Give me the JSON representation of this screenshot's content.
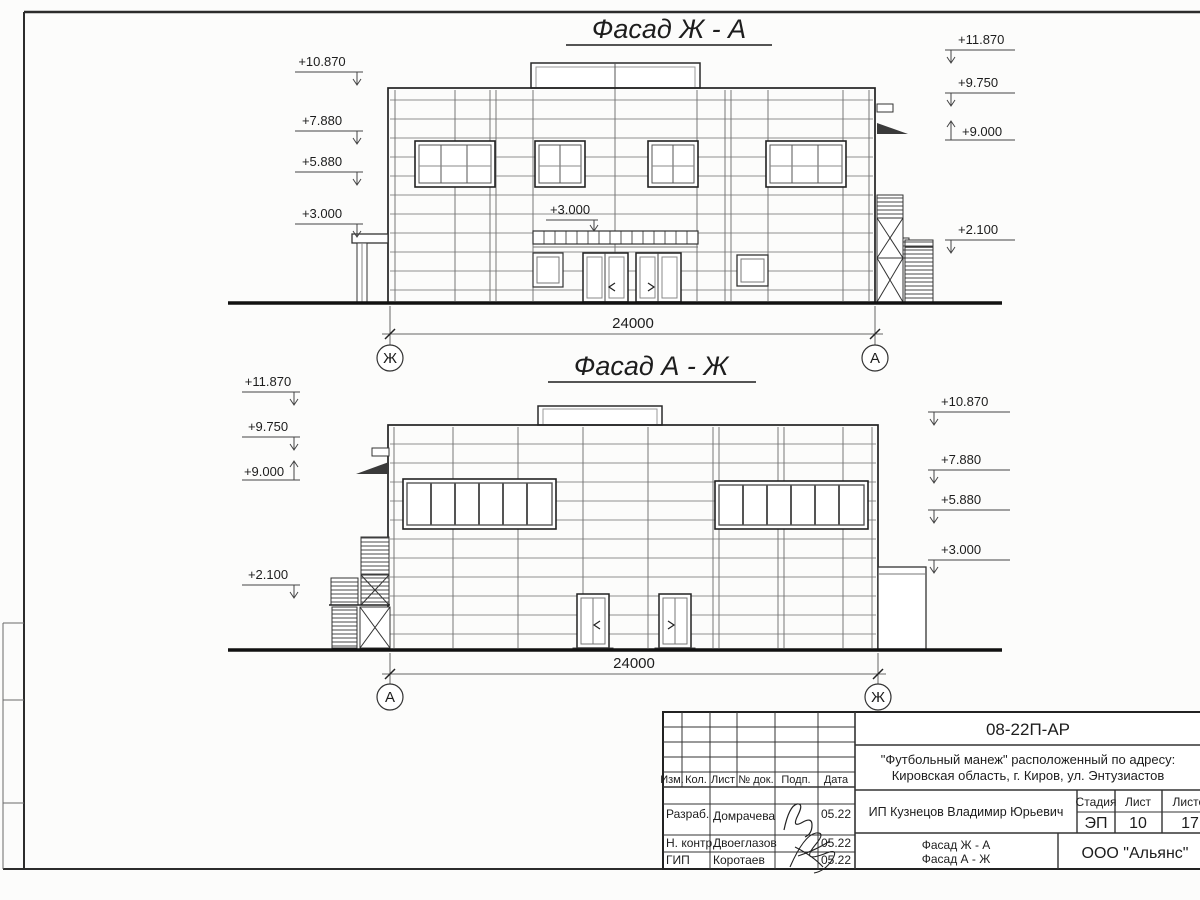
{
  "drawing": {
    "facade1": {
      "title": "Фасад Ж - А",
      "left_marks": [
        "+10.870",
        "+7.880",
        "+5.880",
        "+3.000"
      ],
      "right_marks": [
        "+11.870",
        "+9.750",
        "+9.000",
        "+2.100"
      ],
      "entrance_mark": "+3.000",
      "dimension": "24000",
      "axis_left": "Ж",
      "axis_right": "А"
    },
    "facade2": {
      "title": "Фасад А - Ж",
      "left_marks": [
        "+11.870",
        "+9.750",
        "+9.000",
        "+2.100"
      ],
      "right_marks": [
        "+10.870",
        "+7.880",
        "+5.880",
        "+3.000"
      ],
      "dimension": "24000",
      "axis_left": "А",
      "axis_right": "Ж"
    }
  },
  "title_block": {
    "doc_number": "08-22П-АР",
    "project_line1": "\"Футбольный манеж\" расположенный по адресу:",
    "project_line2": "Кировская область, г. Киров, ул. Энтузиастов",
    "columns": {
      "izm": "Изм.",
      "kol": "Кол.",
      "list": "Лист",
      "doc": "№ док.",
      "podp": "Подп.",
      "data": "Дата"
    },
    "rows": [
      {
        "role": "Разраб.",
        "name": "Домрачева",
        "date": "05.22"
      },
      {
        "role": "Н. контр.",
        "name": "Двоеглазов",
        "date": "05.22"
      },
      {
        "role": "ГИП",
        "name": "Коротаев",
        "date": "05.22"
      }
    ],
    "client": "ИП Кузнецов Владимир Юрьевич",
    "stage_label": "Стадия",
    "sheet_label": "Лист",
    "sheets_label": "Листов",
    "stage": "ЭП",
    "sheet": "10",
    "sheets": "17",
    "content_line1": "Фасад Ж - А",
    "content_line2": "Фасад А - Ж",
    "organization": "ООО \"Альянс\"",
    "line_color": "#3a3a3a"
  }
}
